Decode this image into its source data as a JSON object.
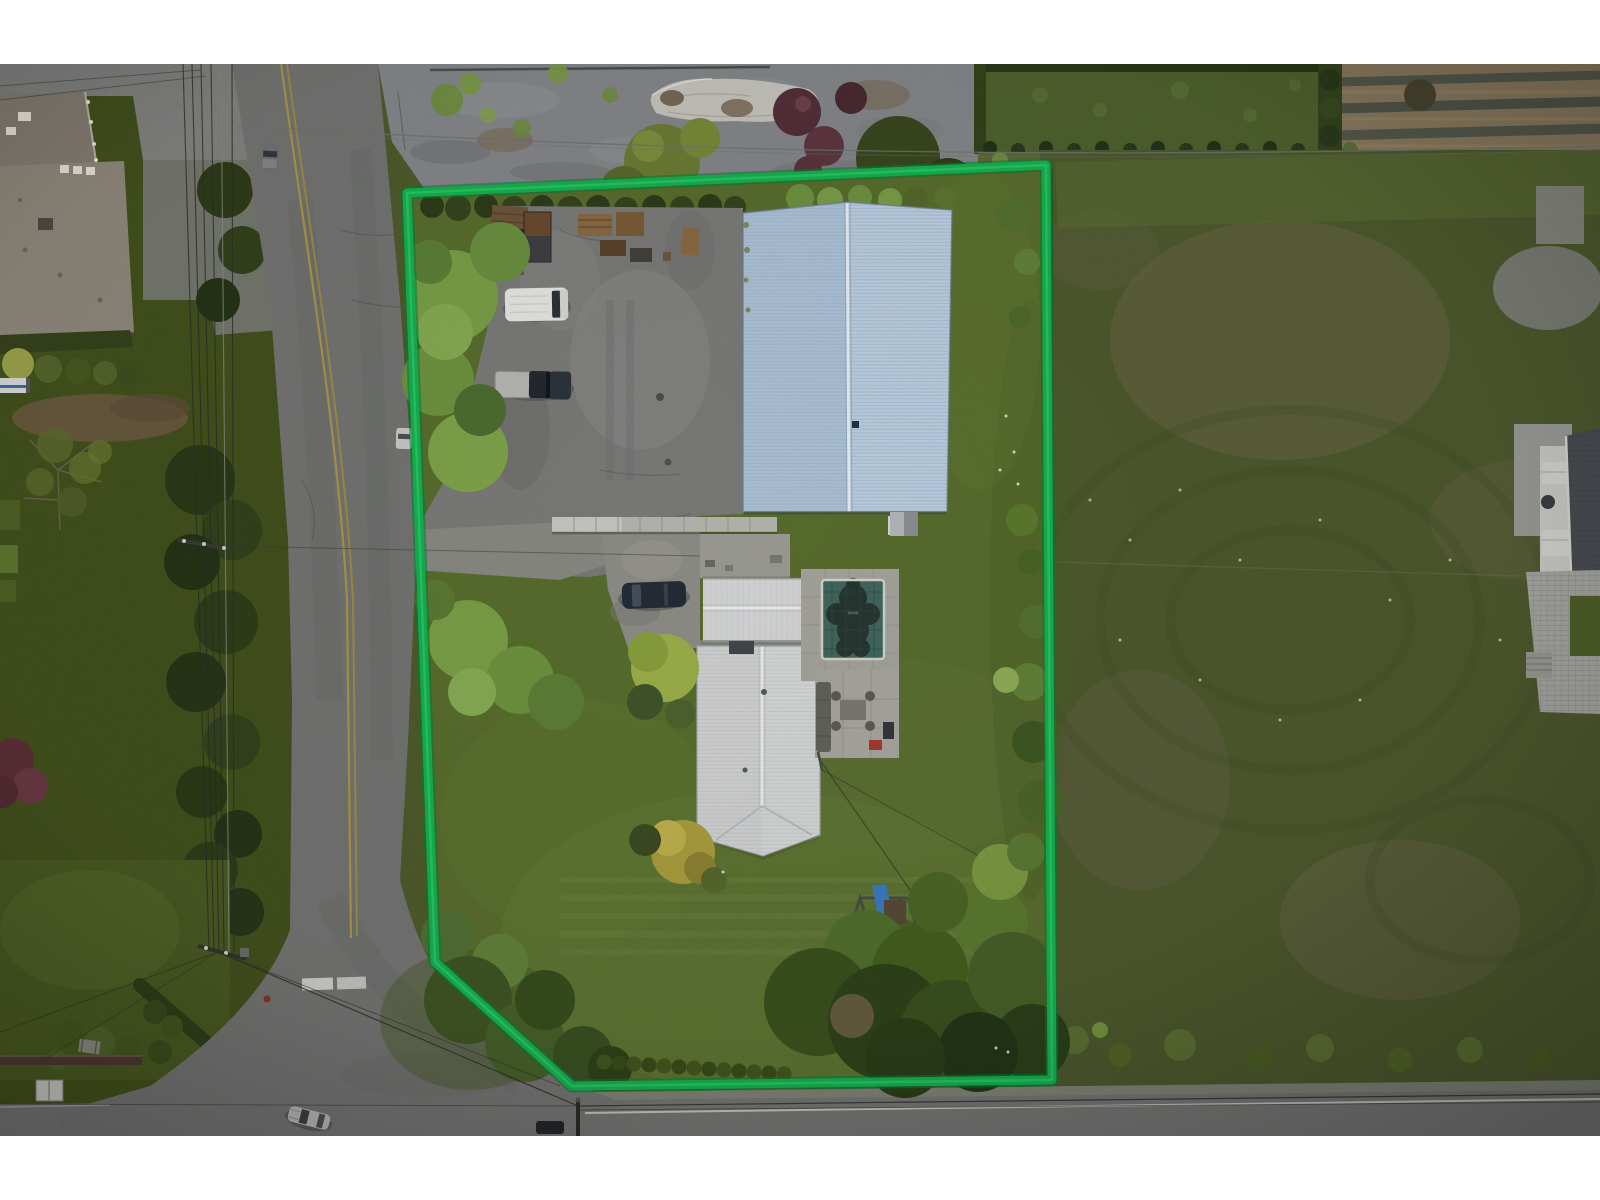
{
  "image": {
    "kind": "aerial-drone-photo",
    "subject": "top-down view of an acreage property with a highlighted lot boundary",
    "letterbox": "white bands at top and bottom"
  },
  "colors": {
    "letterbox_white": "#ffffff",
    "boundary_green": "#14b250",
    "boundary_green_dark": "#0b7d38",
    "asphalt_road": "#747573",
    "bottom_road": "#767775",
    "parking_asphalt": "#7b7b79",
    "gravel_yard": "#85878a",
    "property_lawn": "#5a6e2e",
    "left_lawn": "#43511d",
    "pasture_field": "#4e5a2e",
    "shop_roof_blue": "#bdd0e2",
    "shop_roof_blue_dark": "#afc4d9",
    "house_roof_white": "#d3d4d5",
    "pool_water": "#41685f",
    "pool_cover_blob": "#25322c",
    "pool_deck": "#a6a59d",
    "neighbor_roof": "#8f887c",
    "farm_soil": "#8a7a5f",
    "yellow_line": "#b09a42",
    "road_marking_white": "#d6d6d0"
  },
  "scene": {
    "boundary_points": [
      [
        407,
        193
      ],
      [
        1046,
        165
      ],
      [
        1052,
        1080
      ],
      [
        572,
        1086
      ],
      [
        435,
        962
      ]
    ],
    "property": {
      "structures": [
        "blue metal shop building",
        "white metal-roof house",
        "covered swimming pool",
        "concrete patio with furniture",
        "playground swing set with blue slide",
        "concrete block retaining wall"
      ],
      "vehicles": [
        "white van",
        "dark pickup truck with light canopy",
        "dark sedan on gravel drive"
      ],
      "yard_items": [
        "wooden flatbed trailer",
        "dark utility trailer",
        "pallet stacks",
        "clothesline wires",
        "arborvitae hedge row"
      ]
    },
    "surroundings": {
      "left": "two-lane road with double yellow centre line and utility wires",
      "top_left": "neighbouring house with shake roof and driveway",
      "top": "gravel yard with tarp-covered boat and shrubs",
      "top_right": "green paddock and market-garden rows",
      "right": "large pasture with mowing rings and estate house at edge",
      "bottom": "road with white edge line, parked cars and power poles",
      "bottom_left": "T-intersection with white stop bar and lawn yard"
    }
  }
}
